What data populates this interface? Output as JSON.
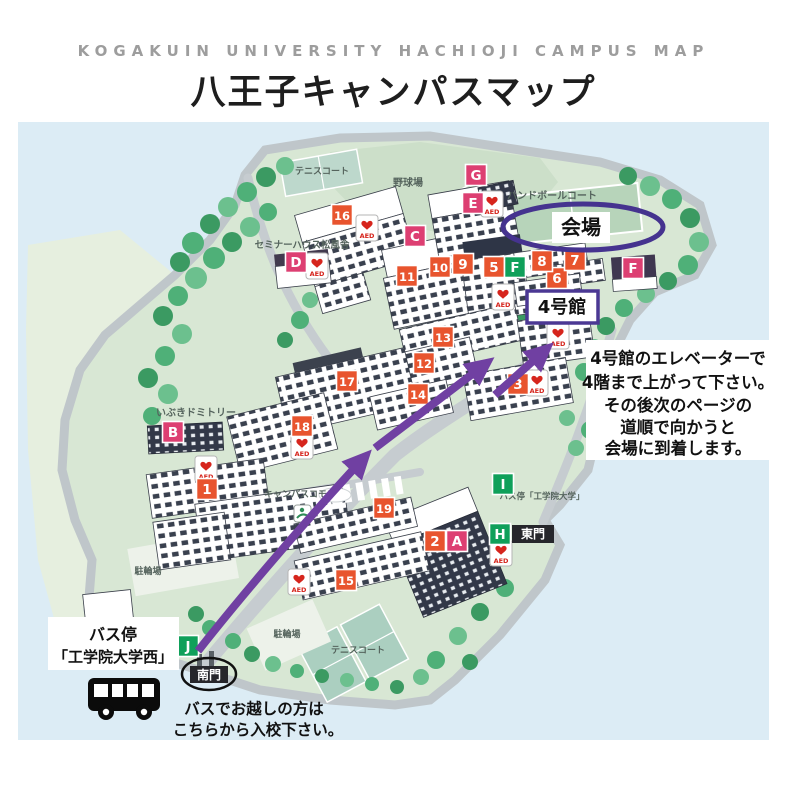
{
  "header": {
    "title_en": "KOGAKUIN UNIVERSITY HACHIOJI CAMPUS MAP",
    "title_jp": "八王子キャンパスマップ"
  },
  "map": {
    "venue_label": "会場",
    "building4_label": "4号館",
    "south_gate_label": "南門",
    "east_gate_label": "東門",
    "instructions": {
      "lines": [
        "4号館のエレベーターで",
        "4階まで上がって下さい。",
        "その後次のページの",
        "道順で向かうと",
        "会場に到着します。"
      ]
    },
    "bus_stop_west": {
      "lines": [
        "バス停",
        "「工学院大学西」"
      ]
    },
    "bus_note": {
      "lines": [
        "バスでお越しの方は",
        "こちらから入校下さい。"
      ]
    },
    "area_labels": [
      {
        "text": "野球場",
        "x": 408,
        "y": 186,
        "s": 10
      },
      {
        "text": "テニスコート",
        "x": 322,
        "y": 174,
        "s": 9
      },
      {
        "text": "ハンドボールコート",
        "x": 552,
        "y": 199,
        "s": 10
      },
      {
        "text": "セミナーハウス松風舎",
        "x": 302,
        "y": 248,
        "s": 9.5
      },
      {
        "text": "いぶきドミトリー",
        "x": 196,
        "y": 416,
        "s": 10
      },
      {
        "text": "キャンパスコモン",
        "x": 300,
        "y": 497,
        "s": 9
      },
      {
        "text": "バス停「工学院大学」",
        "x": 542,
        "y": 499,
        "s": 8.5
      },
      {
        "text": "駐輪場",
        "x": 148,
        "y": 574,
        "s": 9
      },
      {
        "text": "駐輪場",
        "x": 287,
        "y": 637,
        "s": 9
      },
      {
        "text": "テニスコート",
        "x": 358,
        "y": 653,
        "s": 9
      }
    ],
    "markers": [
      {
        "t": "1",
        "x": 207,
        "y": 489,
        "k": "n"
      },
      {
        "t": "2",
        "x": 435,
        "y": 541,
        "k": "n"
      },
      {
        "t": "3",
        "x": 518,
        "y": 384,
        "k": "n"
      },
      {
        "t": "5",
        "x": 494,
        "y": 267,
        "k": "n"
      },
      {
        "t": "6",
        "x": 557,
        "y": 278,
        "k": "n"
      },
      {
        "t": "7",
        "x": 575,
        "y": 260,
        "k": "n"
      },
      {
        "t": "8",
        "x": 542,
        "y": 261,
        "k": "n"
      },
      {
        "t": "9",
        "x": 463,
        "y": 264,
        "k": "n"
      },
      {
        "t": "10",
        "x": 440,
        "y": 267,
        "k": "n"
      },
      {
        "t": "11",
        "x": 407,
        "y": 276,
        "k": "n"
      },
      {
        "t": "12",
        "x": 424,
        "y": 363,
        "k": "n"
      },
      {
        "t": "13",
        "x": 443,
        "y": 337,
        "k": "n"
      },
      {
        "t": "14",
        "x": 418,
        "y": 394,
        "k": "n"
      },
      {
        "t": "15",
        "x": 346,
        "y": 580,
        "k": "n"
      },
      {
        "t": "16",
        "x": 342,
        "y": 215,
        "k": "n"
      },
      {
        "t": "17",
        "x": 347,
        "y": 381,
        "k": "n"
      },
      {
        "t": "18",
        "x": 302,
        "y": 426,
        "k": "n"
      },
      {
        "t": "19",
        "x": 384,
        "y": 508,
        "k": "n"
      },
      {
        "t": "A",
        "x": 457,
        "y": 541,
        "k": "p"
      },
      {
        "t": "B",
        "x": 173,
        "y": 432,
        "k": "p"
      },
      {
        "t": "C",
        "x": 415,
        "y": 236,
        "k": "p"
      },
      {
        "t": "D",
        "x": 296,
        "y": 262,
        "k": "p"
      },
      {
        "t": "E",
        "x": 473,
        "y": 203,
        "k": "p"
      },
      {
        "t": "F",
        "x": 633,
        "y": 268,
        "k": "p"
      },
      {
        "t": "G",
        "x": 476,
        "y": 175,
        "k": "p"
      },
      {
        "t": "F",
        "x": 515,
        "y": 267,
        "k": "g"
      },
      {
        "t": "H",
        "x": 500,
        "y": 534,
        "k": "g"
      },
      {
        "t": "I",
        "x": 503,
        "y": 484,
        "k": "g"
      },
      {
        "t": "J",
        "x": 188,
        "y": 646,
        "k": "g"
      }
    ],
    "aed": {
      "label": "AED",
      "positions": [
        [
          367,
          228
        ],
        [
          317,
          266
        ],
        [
          492,
          204
        ],
        [
          503,
          297
        ],
        [
          558,
          336
        ],
        [
          537,
          383
        ],
        [
          302,
          446
        ],
        [
          206,
          469
        ],
        [
          299,
          582
        ],
        [
          501,
          553
        ]
      ]
    },
    "colors": {
      "number_marker": "#e8542e",
      "letter_marker_pink": "#dd3f72",
      "letter_marker_green": "#0fa05a",
      "route": "#7040a2",
      "venue_ellipse": "#45338f",
      "box_border": "#4b3894",
      "aed_red": "#d6251d",
      "gate_bg": "#26262b"
    }
  }
}
